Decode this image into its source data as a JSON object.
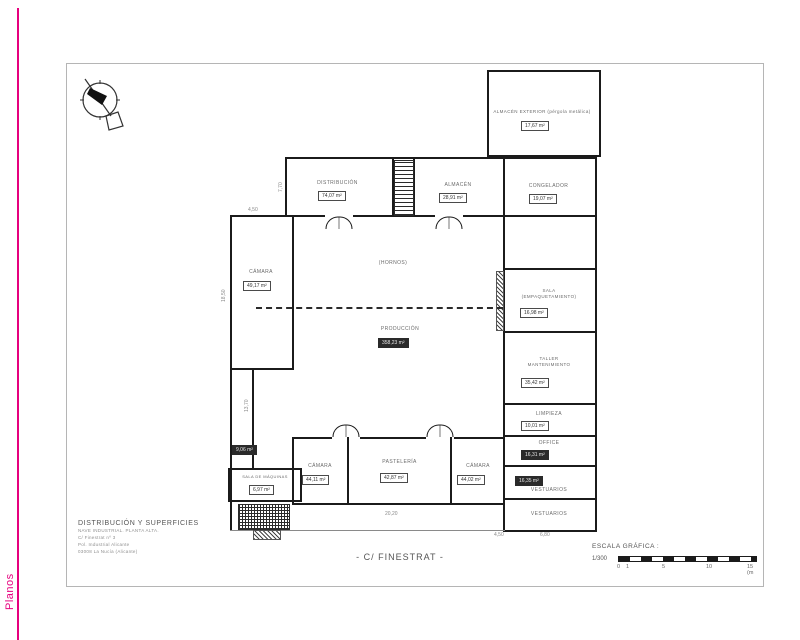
{
  "page": {
    "side_label": "Planos",
    "accent_color": "#e6007e"
  },
  "plan": {
    "street_label": "- C/ FINESTRAT -",
    "rooms": {
      "almacen_exterior": {
        "label": "ALMACÉN EXTERIOR (pérgola metálica)",
        "area": "17,67 m²"
      },
      "distribucion": {
        "label": "DISTRIBUCIÓN",
        "area": "74,07 m²"
      },
      "almacen": {
        "label": "ALMACÉN",
        "area": "28,91 m²"
      },
      "congelador": {
        "label": "CONGELADOR",
        "area": "19,07 m²"
      },
      "camara_izq": {
        "label": "CÁMARA",
        "area": "49,17 m²"
      },
      "hornos": {
        "label": "(HORNOS)"
      },
      "produccion": {
        "label": "PRODUCCIÓN",
        "area": "358,23 m²"
      },
      "sala": {
        "label": "SALA",
        "label2": "(EMPAQUETAMIENTO)",
        "area": "16,98 m²"
      },
      "taller": {
        "label": "TALLER",
        "label2": "MANTENIMIENTO",
        "area": "35,42 m²"
      },
      "limpieza": {
        "label": "LIMPIEZA",
        "area": "10,01 m²"
      },
      "office": {
        "label": "OFFICE",
        "area": "16,31 m²"
      },
      "vestuarios_1": {
        "label": "VESTUARIOS",
        "area": "16,35 m²"
      },
      "vestuarios_2": {
        "label": "VESTUARIOS"
      },
      "camara_b1": {
        "label": "CÁMARA",
        "area": "44,11 m²"
      },
      "pasteleria": {
        "label": "PASTELERÍA",
        "area": "42,87 m²"
      },
      "camara_b2": {
        "label": "CÁMARA",
        "area": "44,02 m²"
      },
      "sala_maquinas": {
        "label": "SALA DE MÁQUINAS",
        "area": "6,97 m²"
      },
      "pasillo": {
        "area": "9,06 m²"
      }
    },
    "dimensions": {
      "d1": "7,70",
      "d2": "4,50",
      "d3": "18,50",
      "d4": "13,70",
      "d5": "20,20",
      "d6": "4,50",
      "d7": "6,80"
    }
  },
  "title_block": {
    "heading": "DISTRIBUCIÓN Y SUPERFICIES",
    "line1": "NAVE INDUSTRIAL. PLANTA ALTA.",
    "line2": "C/ Finestrat nº 3",
    "line3": "Pol. Industrial Alicante",
    "line4": "03008 La Nucía (Alicante)"
  },
  "scale": {
    "heading": "ESCALA GRÁFICA :",
    "ratio": "1/300",
    "tick_0": "0",
    "tick_1": "1",
    "tick_5": "5",
    "tick_10": "10",
    "tick_15": "15 (m"
  }
}
